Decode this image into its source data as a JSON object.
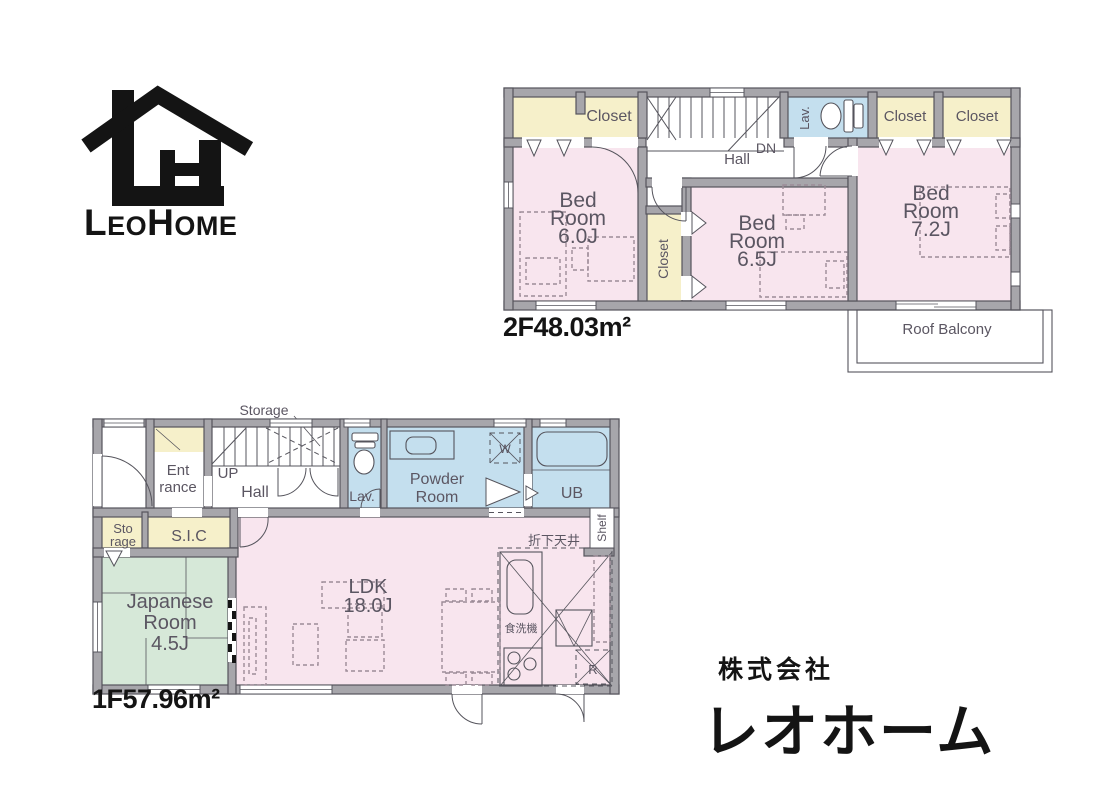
{
  "logo": {
    "mark": "house-lh-monogram",
    "wordmark": {
      "p1": "L",
      "p2": "EO",
      "p3": "H",
      "p4": "OME"
    }
  },
  "company": {
    "line1": "株式会社",
    "line2": "レオホーム"
  },
  "floor2": {
    "area_label": "2F48.03m²",
    "labels": {
      "closet_a": "Closet",
      "lav": "Lav.",
      "closet_b": "Closet",
      "closet_c": "Closet",
      "dn": "DN",
      "hall": "Hall",
      "bed1": [
        "Bed",
        "Room",
        "6.0J"
      ],
      "closet_d": "Closet",
      "bed2": [
        "Bed",
        "Room",
        "6.5J"
      ],
      "bed3": [
        "Bed",
        "Room",
        "7.2J"
      ],
      "roof_balcony": "Roof Balcony"
    }
  },
  "floor1": {
    "area_label": "1F57.96m²",
    "labels": {
      "storage_stairs": "Storage",
      "entrance": [
        "Ent",
        "rance"
      ],
      "up": "UP",
      "hall": "Hall",
      "lav": "Lav.",
      "powder": [
        "Powder",
        "Room"
      ],
      "washer": "W",
      "ub": "UB",
      "storage_small": [
        "Sto",
        "rage"
      ],
      "sic": "S.I.C",
      "japanese": [
        "Japanese",
        "Room",
        "4.5J"
      ],
      "ldk": [
        "LDK",
        "18.0J"
      ],
      "lowered_ceiling": "折下天井",
      "shelf": "Shelf",
      "dishwasher": "食洗機",
      "fridge": "R"
    }
  },
  "colors": {
    "wall": "#a7a6ab",
    "wall-edge": "#55545c",
    "room-pink": "#f8e5ee",
    "room-cream": "#f6f0ca",
    "room-blue": "#c4dfee",
    "room-green": "#d6e8d8",
    "line-dark": "#55545c",
    "furniture": "#9c8b97",
    "label": "#5b5662",
    "ink": "#141414"
  }
}
